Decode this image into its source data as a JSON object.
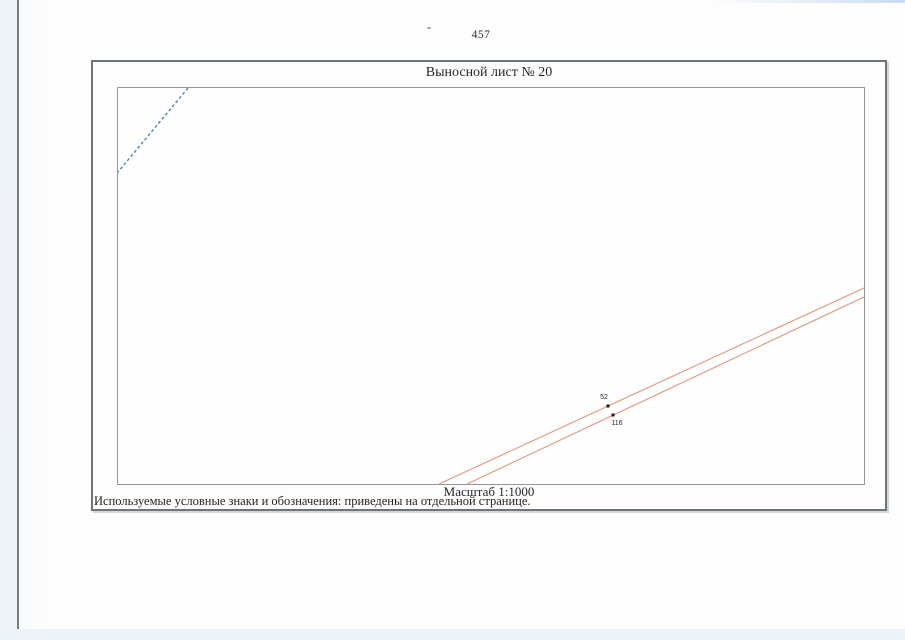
{
  "document": {
    "page_number": "457",
    "title": "Выносной лист № 20",
    "scale": "Масштаб 1:1000",
    "footnote": "Используемые условные знаки и обозначения: приведены на отдельной странице."
  },
  "map": {
    "points": [
      {
        "id": "52"
      },
      {
        "id": "116"
      }
    ],
    "colors": {
      "parcel_line": "#e5957c",
      "dashed_line": "#4a86ae",
      "point_marker": "#1c1c1c"
    }
  }
}
